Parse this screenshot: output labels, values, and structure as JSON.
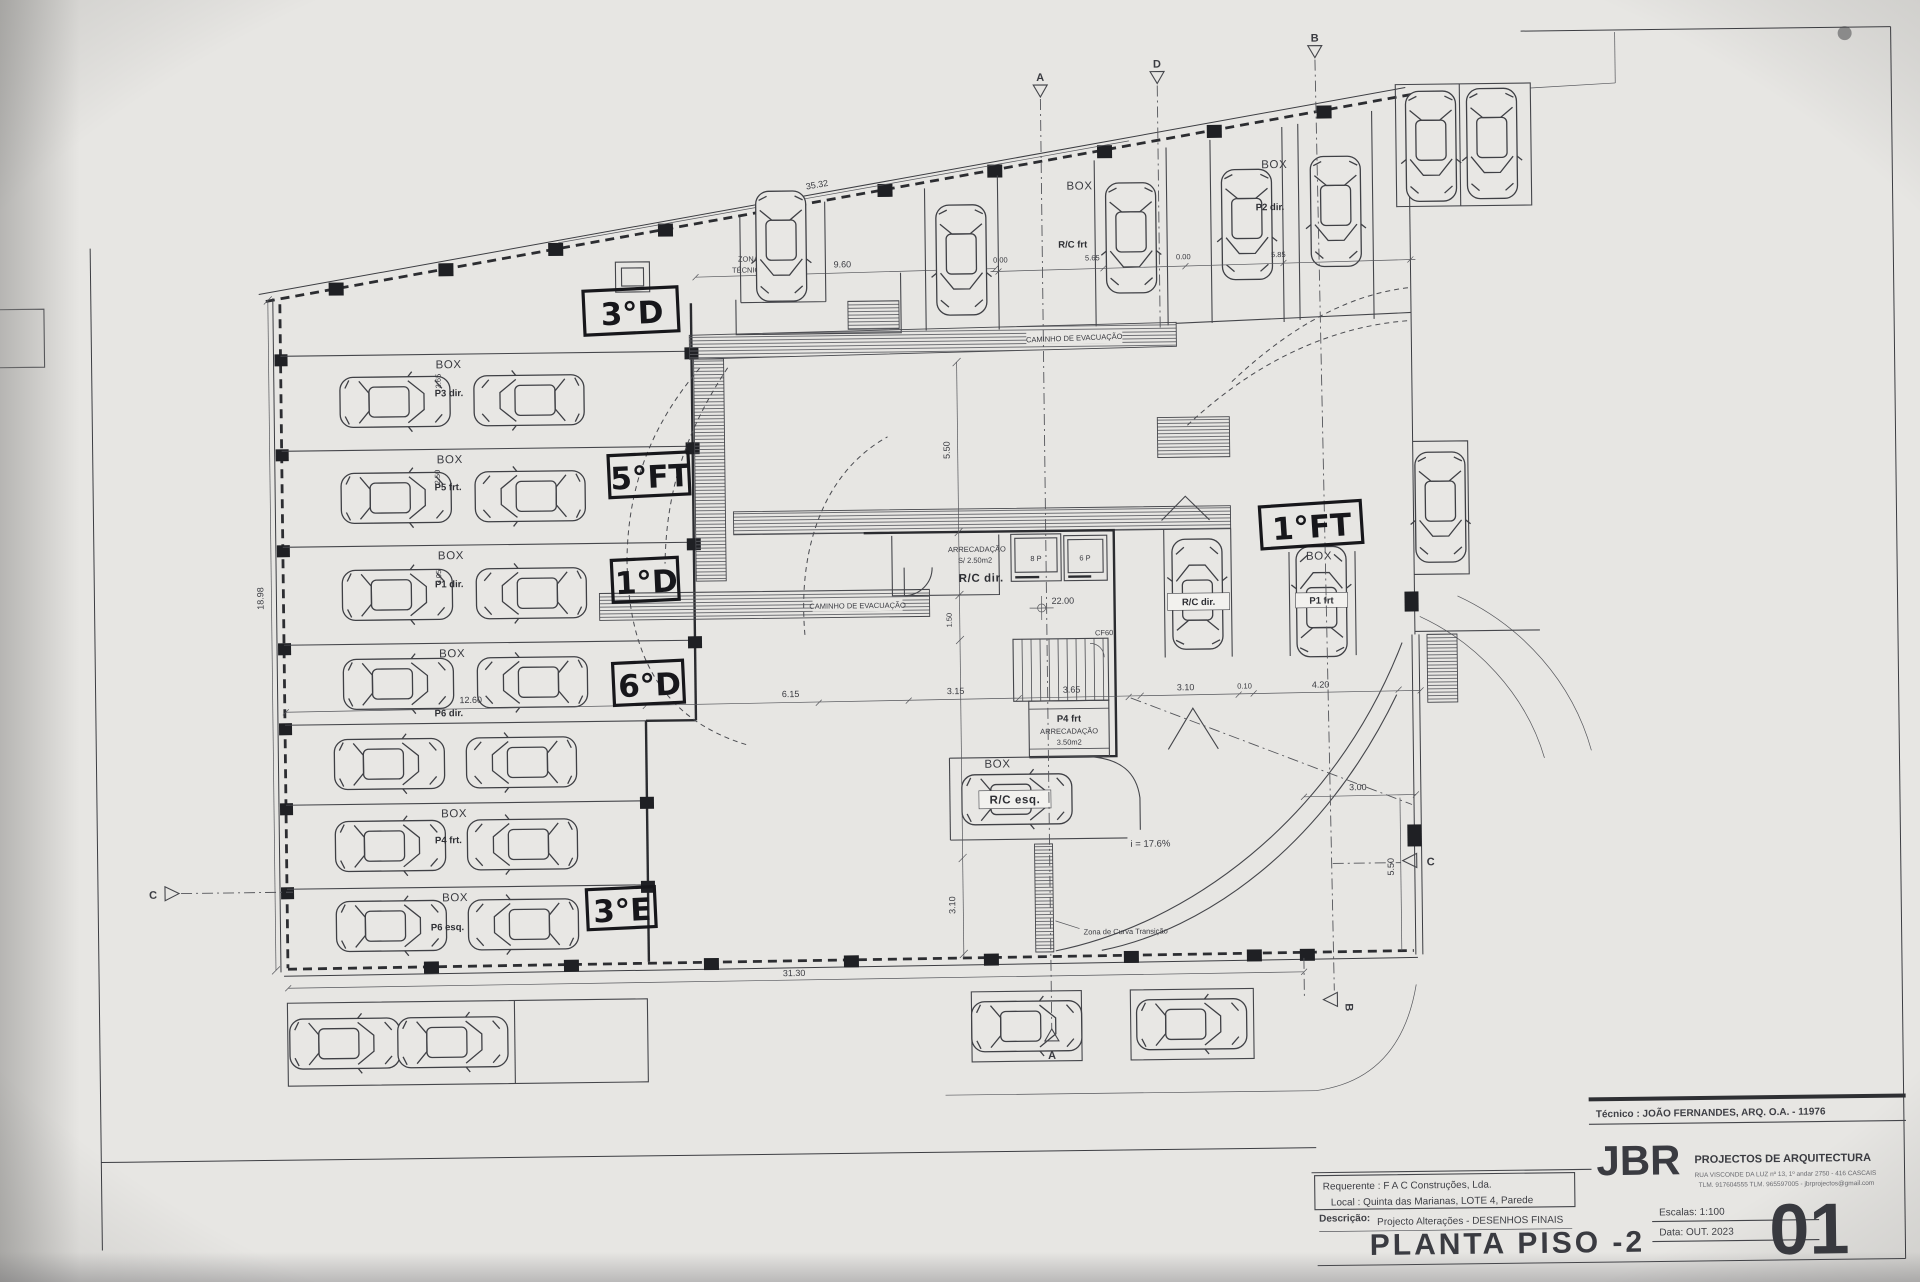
{
  "title_block": {
    "tecnico": "Técnico : JOÃO FERNANDES, ARQ.   O.A. - 11976",
    "firm_logo": "JBR",
    "firm_name": "PROJECTOS DE ARQUITECTURA",
    "firm_address": "RUA VISCONDE DA LUZ nº 13, 1º andar  2750 - 416  CASCAIS",
    "firm_contacts": "TLM. 917604555  TLM. 965597005 - jbrprojectos@gmail.com",
    "requerente": "Requerente : F A C  Construções, Lda.",
    "local": "Local : Quinta das Marianas, LOTE 4, Parede",
    "descricao_label": "Descrição:",
    "descricao": "Projecto Alterações - DESENHOS FINAIS",
    "drawing_title": "PLANTA PISO -2",
    "escalas": "Escalas:  1:100",
    "data": "Data: OUT.  2023",
    "sheet_number": "01"
  },
  "handwritten": {
    "l1": "3°D",
    "l2": "5°FT",
    "l3": "1°D",
    "l4": "6°D",
    "l5": "3°E",
    "l6": "1°FT"
  },
  "labels": {
    "box": "BOX",
    "zona_tecnica_1": "ZONA",
    "zona_tecnica_2": "TÉCNICA",
    "caminho": "CAMINHO DE EVACUAÇÃO",
    "arrecadacao": "ARRECADAÇÃO",
    "arrecadacao_area": "S/ 2.50m2",
    "rc_dir_room": "R/C dir.",
    "p4_frt_core": "P4 frt",
    "arrecadacao2": "ARRECADAÇÃO",
    "arrecadacao2_area": "3.50m2",
    "lift_left": "8 P",
    "lift_right": "6 P",
    "fire_door": "CF60",
    "slope": "i = 17.6%",
    "curve_zone": "Zona de Curva Transição",
    "rc_frt": "R/C frt",
    "p2_dir": "P2 dir.",
    "rc_dir_car": "R/C dir.",
    "p1_frt": "P1 frt",
    "rc_esq": "R/C esq.",
    "row1": "P3 dir.",
    "row2": "P5 frt.",
    "row3": "P1 dir.",
    "row4": "P6 dir.",
    "row6": "P4 frt.",
    "row7": "P6 esq.",
    "sec_a": "A",
    "sec_b": "B",
    "sec_c": "C",
    "sec_d": "D"
  },
  "dims": {
    "d35_32": "35.32",
    "d9_60": "9.60",
    "d0_00a": "0.00",
    "d5_65": "5.65",
    "d0_00b": "0.00",
    "d5_85": "5.85",
    "d18_98": "18.98",
    "d3_65": "3.65",
    "d2_50": "2.50",
    "d3_05": "3.05",
    "d12_60": "12.60",
    "d6_15": "6.15",
    "d3_15": "3.15",
    "d3_65b": "3.65",
    "d3_10": "3.10",
    "d0_10": "0.10",
    "d4_20": "4.20",
    "d5_50": "5.50",
    "d1_50": "1.50",
    "d3_10b": "3.10",
    "d3_00": "3.00",
    "d5_50b": "5.50",
    "d31_30": "31.30",
    "d22_00": "22.00"
  }
}
